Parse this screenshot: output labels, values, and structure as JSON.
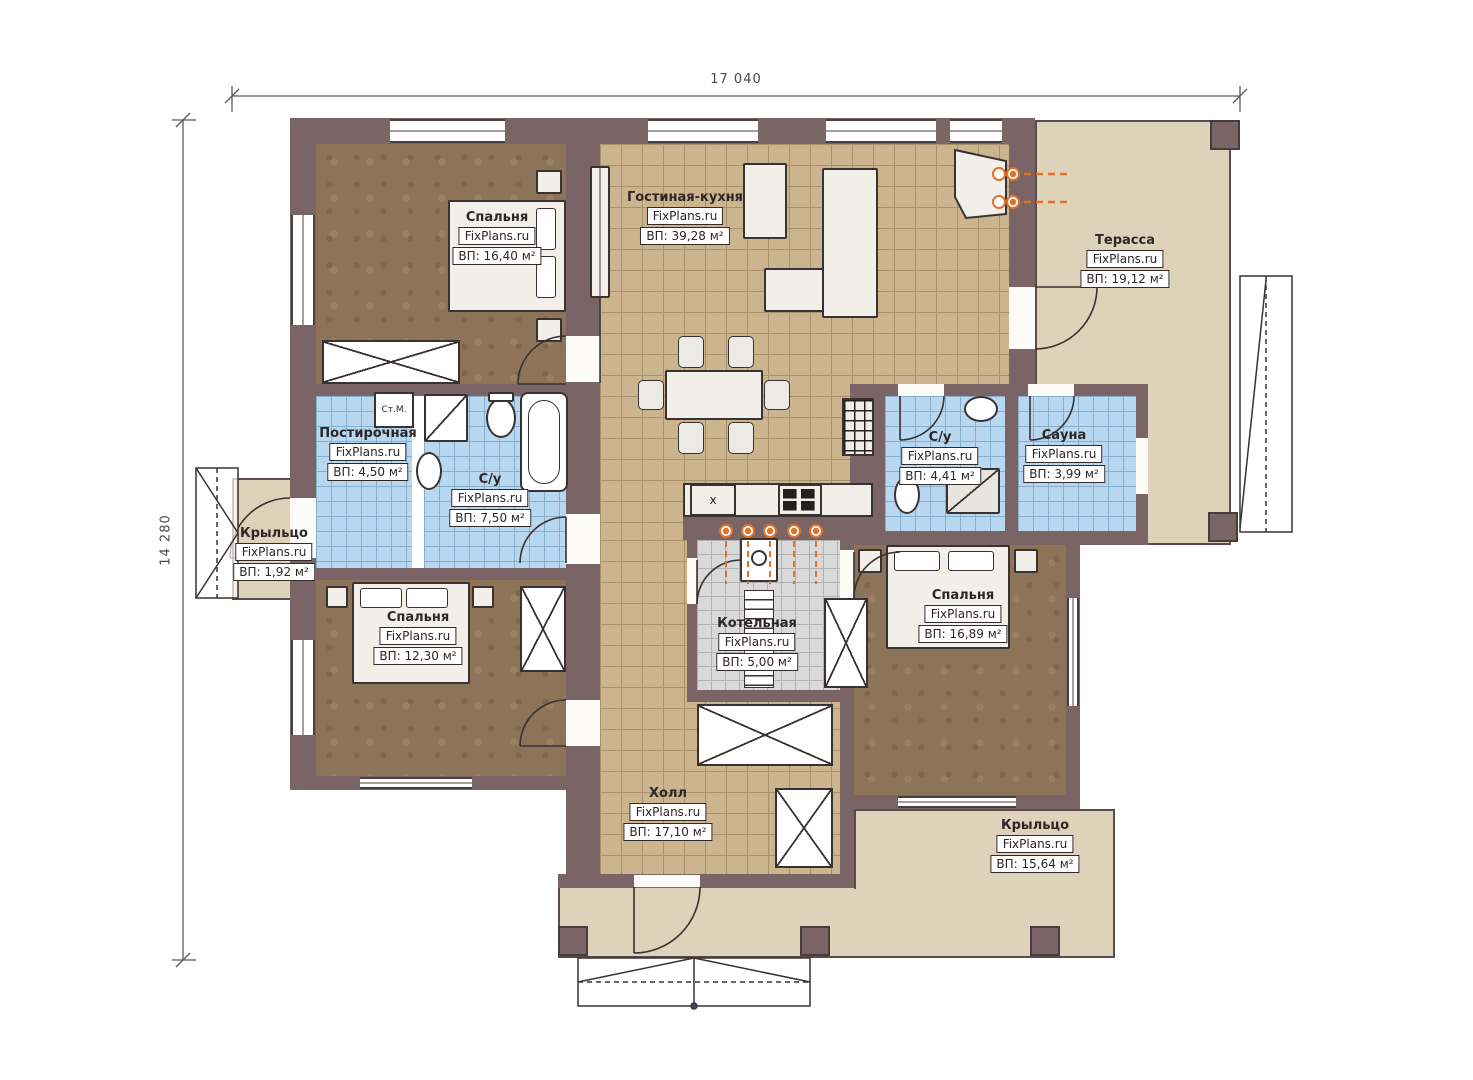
{
  "plan": {
    "brand": "FixPlans.ru",
    "dimensions": {
      "width": "17 040",
      "height": "14 280"
    },
    "rooms": [
      {
        "key": "bedroom-1",
        "name": "Спальня",
        "site": "FixPlans.ru",
        "area": "ВП: 16,40 м²"
      },
      {
        "key": "living-kitchen",
        "name": "Гостиная-кухня",
        "site": "FixPlans.ru",
        "area": "ВП: 39,28 м²"
      },
      {
        "key": "terrace",
        "name": "Терасса",
        "site": "FixPlans.ru",
        "area": "ВП: 19,12 м²"
      },
      {
        "key": "laundry",
        "name": "Постирочная",
        "site": "FixPlans.ru",
        "area": "ВП: 4,50 м²"
      },
      {
        "key": "bathroom-1",
        "name": "С/у",
        "site": "FixPlans.ru",
        "area": "ВП: 7,50 м²"
      },
      {
        "key": "porch-left",
        "name": "Крыльцо",
        "site": "FixPlans.ru",
        "area": "ВП: 1,92 м²"
      },
      {
        "key": "bedroom-2",
        "name": "Спальня",
        "site": "FixPlans.ru",
        "area": "ВП: 12,30 м²"
      },
      {
        "key": "bathroom-2",
        "name": "С/у",
        "site": "FixPlans.ru",
        "area": "ВП: 4,41 м²"
      },
      {
        "key": "sauna",
        "name": "Сауна",
        "site": "FixPlans.ru",
        "area": "ВП: 3,99 м²"
      },
      {
        "key": "bedroom-3",
        "name": "Спальня",
        "site": "FixPlans.ru",
        "area": "ВП: 16,89 м²"
      },
      {
        "key": "boiler",
        "name": "Котельная",
        "site": "FixPlans.ru",
        "area": "ВП: 5,00 м²"
      },
      {
        "key": "hall",
        "name": "Холл",
        "site": "FixPlans.ru",
        "area": "ВП: 17,10 м²"
      },
      {
        "key": "porch-main",
        "name": "Крыльцо",
        "site": "FixPlans.ru",
        "area": "ВП: 15,64 м²"
      }
    ],
    "annotations": {
      "washing_machine": "Ст.М.",
      "kitchen_sink_mark": "x"
    },
    "colors": {
      "wall": "#7a6466",
      "bedroom_floor": "#8d7458",
      "tile_floor": "#cbb48e",
      "bath_floor": "#b7d8f0",
      "porch": "#ded2bb",
      "boiler_floor": "#d9d9d9",
      "accent": "#e0722a"
    }
  }
}
